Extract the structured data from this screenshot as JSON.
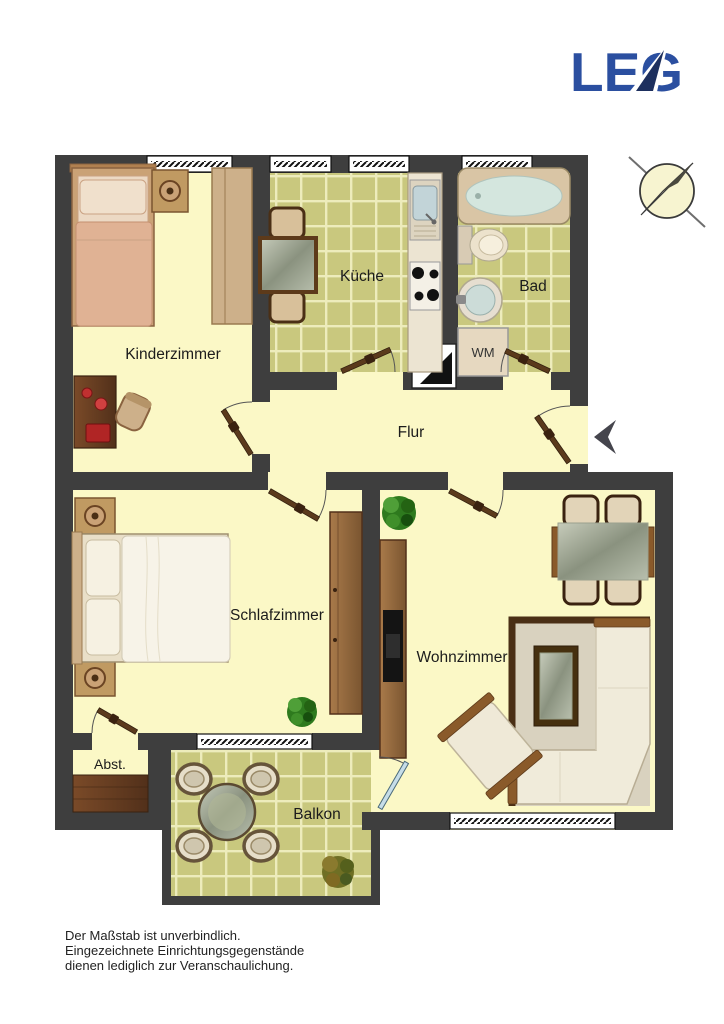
{
  "brand": {
    "logo_text": "LEG",
    "logo_color": "#2b4fa0",
    "logo_arrow_color": "#1d2f5e"
  },
  "rooms": {
    "kinderzimmer": {
      "label": "Kinderzimmer"
    },
    "kueche": {
      "label": "Küche"
    },
    "bad": {
      "label": "Bad"
    },
    "flur": {
      "label": "Flur"
    },
    "schlafzimmer": {
      "label": "Schlafzimmer"
    },
    "wohnzimmer": {
      "label": "Wohnzimmer"
    },
    "abstellraum": {
      "label": "Abst."
    },
    "balkon": {
      "label": "Balkon"
    }
  },
  "appliances": {
    "washing_machine": {
      "label": "WM"
    }
  },
  "icons": {
    "compass": "north-compass-needle",
    "entrance_arrow": "entrance-direction-arrow"
  },
  "disclaimer": {
    "lines": [
      "Der Maßstab ist unverbindlich.",
      "Eingezeichnete Einrichtungsgegenstände",
      "dienen lediglich zur Veranschaulichung."
    ]
  },
  "colors": {
    "wall": "#3e3e3e",
    "floor": "#fbf8c6",
    "tile": "#c9c87e",
    "tile_line": "#edecbc",
    "logo_blue": "#2b4fa0"
  }
}
